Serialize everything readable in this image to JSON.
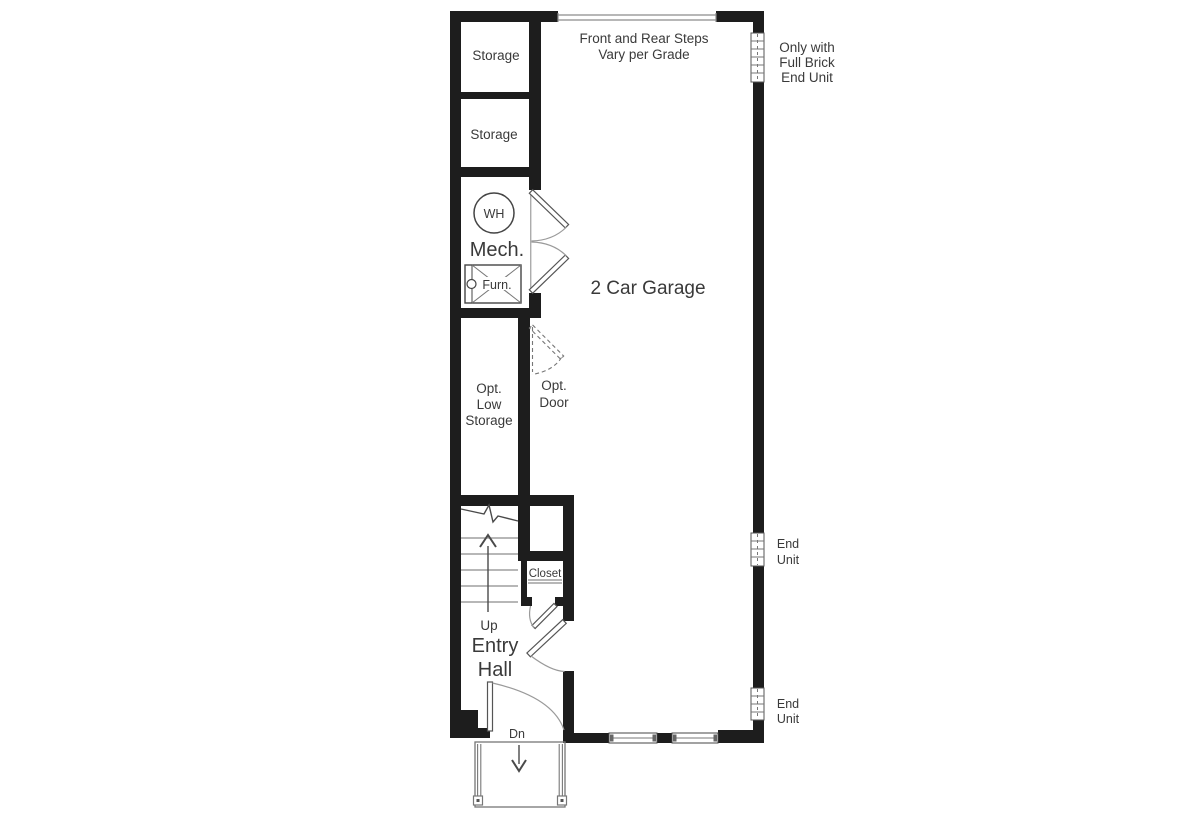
{
  "plan": {
    "type": "floor-plan",
    "colors": {
      "wall": "#1d1d1d",
      "line": "#8c8c8c",
      "text": "#3a3a3a",
      "background": "#ffffff"
    },
    "rooms": {
      "storage_1": {
        "label": "Storage"
      },
      "storage_2": {
        "label": "Storage"
      },
      "mech": {
        "label": "Mech."
      },
      "water_heater": {
        "label": "WH"
      },
      "furnace": {
        "label": "Furn."
      },
      "opt_low_storage": {
        "lines": [
          "Opt.",
          "Low",
          "Storage"
        ]
      },
      "garage": {
        "label": "2 Car Garage"
      },
      "closet": {
        "label": "Closet"
      },
      "entry_hall": {
        "lines": [
          "Entry",
          "Hall"
        ]
      }
    },
    "annotations": {
      "steps_note": {
        "lines": [
          "Front and Rear Steps",
          "Vary per Grade"
        ]
      },
      "brick_note": {
        "lines": [
          "Only with",
          "Full Brick",
          "End Unit"
        ]
      },
      "end_unit_mid": {
        "lines": [
          "End",
          "Unit"
        ]
      },
      "end_unit_bottom": {
        "lines": [
          "End",
          "Unit"
        ]
      },
      "opt_door": {
        "lines": [
          "Opt.",
          "Door"
        ]
      },
      "stair_up": {
        "label": "Up"
      },
      "stair_down": {
        "label": "Dn"
      }
    }
  }
}
